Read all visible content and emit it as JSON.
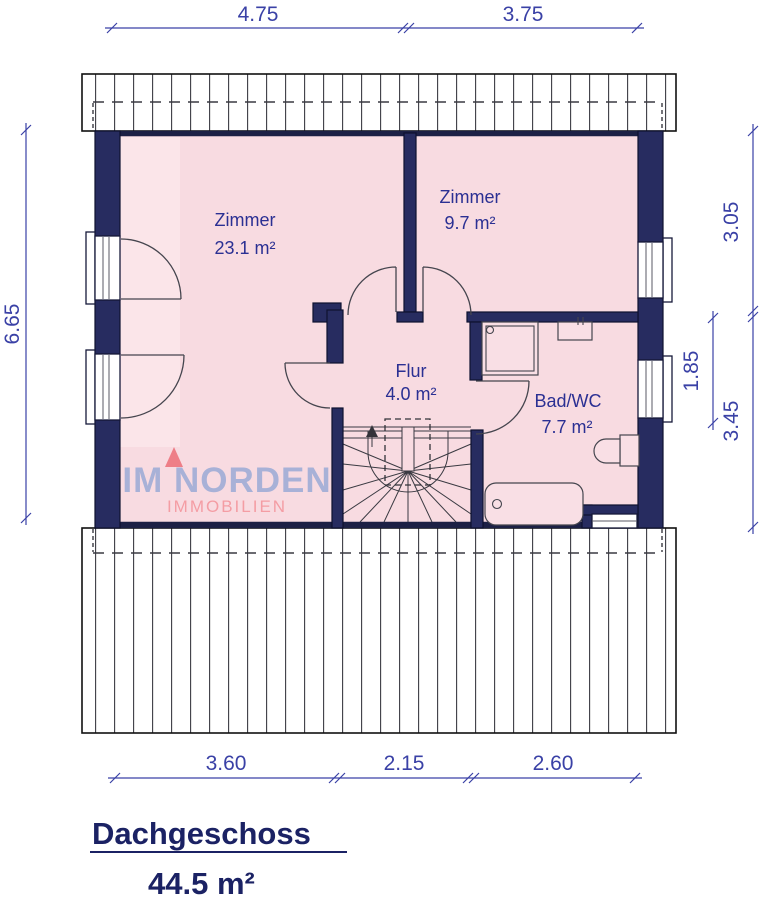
{
  "title_block": {
    "title": "Dachgeschoss",
    "area": "44.5 m²"
  },
  "watermark": {
    "brand": "IM NORDEN",
    "sub": "IMMOBILIEN"
  },
  "rooms": [
    {
      "name": "Zimmer",
      "area": "23.1 m²"
    },
    {
      "name": "Zimmer",
      "area": "9.7 m²"
    },
    {
      "name": "Flur",
      "area": "4.0 m²"
    },
    {
      "name": "Bad/WC",
      "area": "7.7 m²"
    }
  ],
  "dimensions": {
    "top": [
      "4.75",
      "3.75"
    ],
    "bottom": [
      "3.60",
      "2.15",
      "2.60"
    ],
    "left": [
      "6.65"
    ],
    "right_outer": [
      "3.05",
      "3.45"
    ],
    "right_inner": [
      "1.85"
    ]
  },
  "colors": {
    "wall_navy": "#272c60",
    "room_pink": "#f8dbe1",
    "dimension_blue": "#3a41a6",
    "room_label_blue": "#2b3093",
    "title_navy": "#1b2264",
    "watermark_blue": "#a8b1d7",
    "watermark_pink": "#f49da4",
    "watermark_triangle": "#ee7e87"
  }
}
